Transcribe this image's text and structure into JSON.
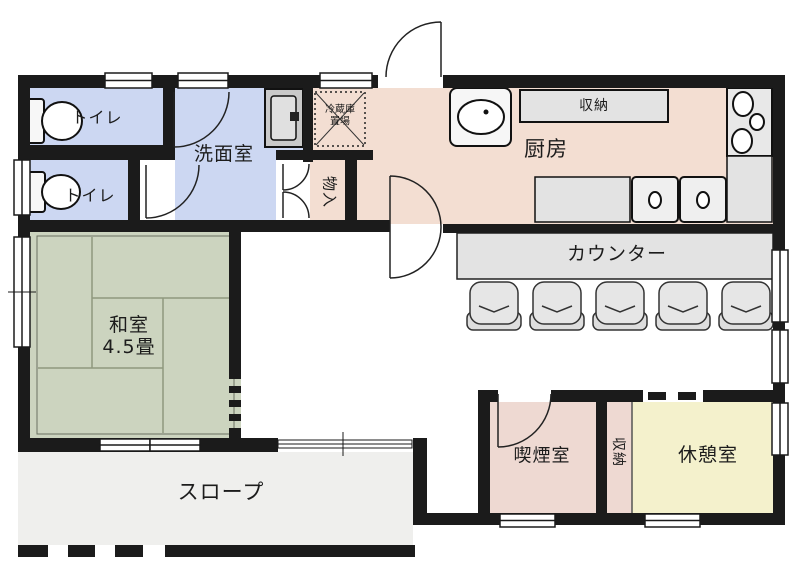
{
  "plan_title": "間取り図",
  "rooms": {
    "toilet1": {
      "label": "トイレ",
      "color": "#ccd7f2"
    },
    "toilet2": {
      "label": "トイレ",
      "color": "#ccd7f2"
    },
    "washroom": {
      "label": "洗面室",
      "color": "#ccd7f2"
    },
    "closet_hall": {
      "label": "物入",
      "color": "#f3ded2"
    },
    "kitchen": {
      "label": "厨房",
      "color": "#f3ded2"
    },
    "washitsu": {
      "label_line1": "和室",
      "label_line2": "4.5畳",
      "color": "#ccd4bf"
    },
    "slope": {
      "label": "スロープ",
      "color": "#efefed"
    },
    "smoking": {
      "label": "喫煙室",
      "color": "#eed9d2"
    },
    "closet_south": {
      "label": "収納",
      "color": "#eed9d2"
    },
    "rest": {
      "label": "休憩室",
      "color": "#f4f1cc"
    }
  },
  "fixtures": {
    "kitchen_storage_label": "収納",
    "fridge_label_line1": "冷蔵庫",
    "fridge_label_line2": "置場",
    "counter_label": "カウンター",
    "counter_stool_count": 5,
    "stove_burner_count": 3,
    "toilet_count": 2
  },
  "colors": {
    "wall": "#1b1b1b",
    "water_rooms": "#ccd7f2",
    "kitchen_rooms": "#f3ded2",
    "tatami_room": "#ccd4bf",
    "rest_room": "#f4f1cc",
    "slope": "#efefed",
    "fixture_gray": "#e3e3e3",
    "background": "#ffffff"
  }
}
